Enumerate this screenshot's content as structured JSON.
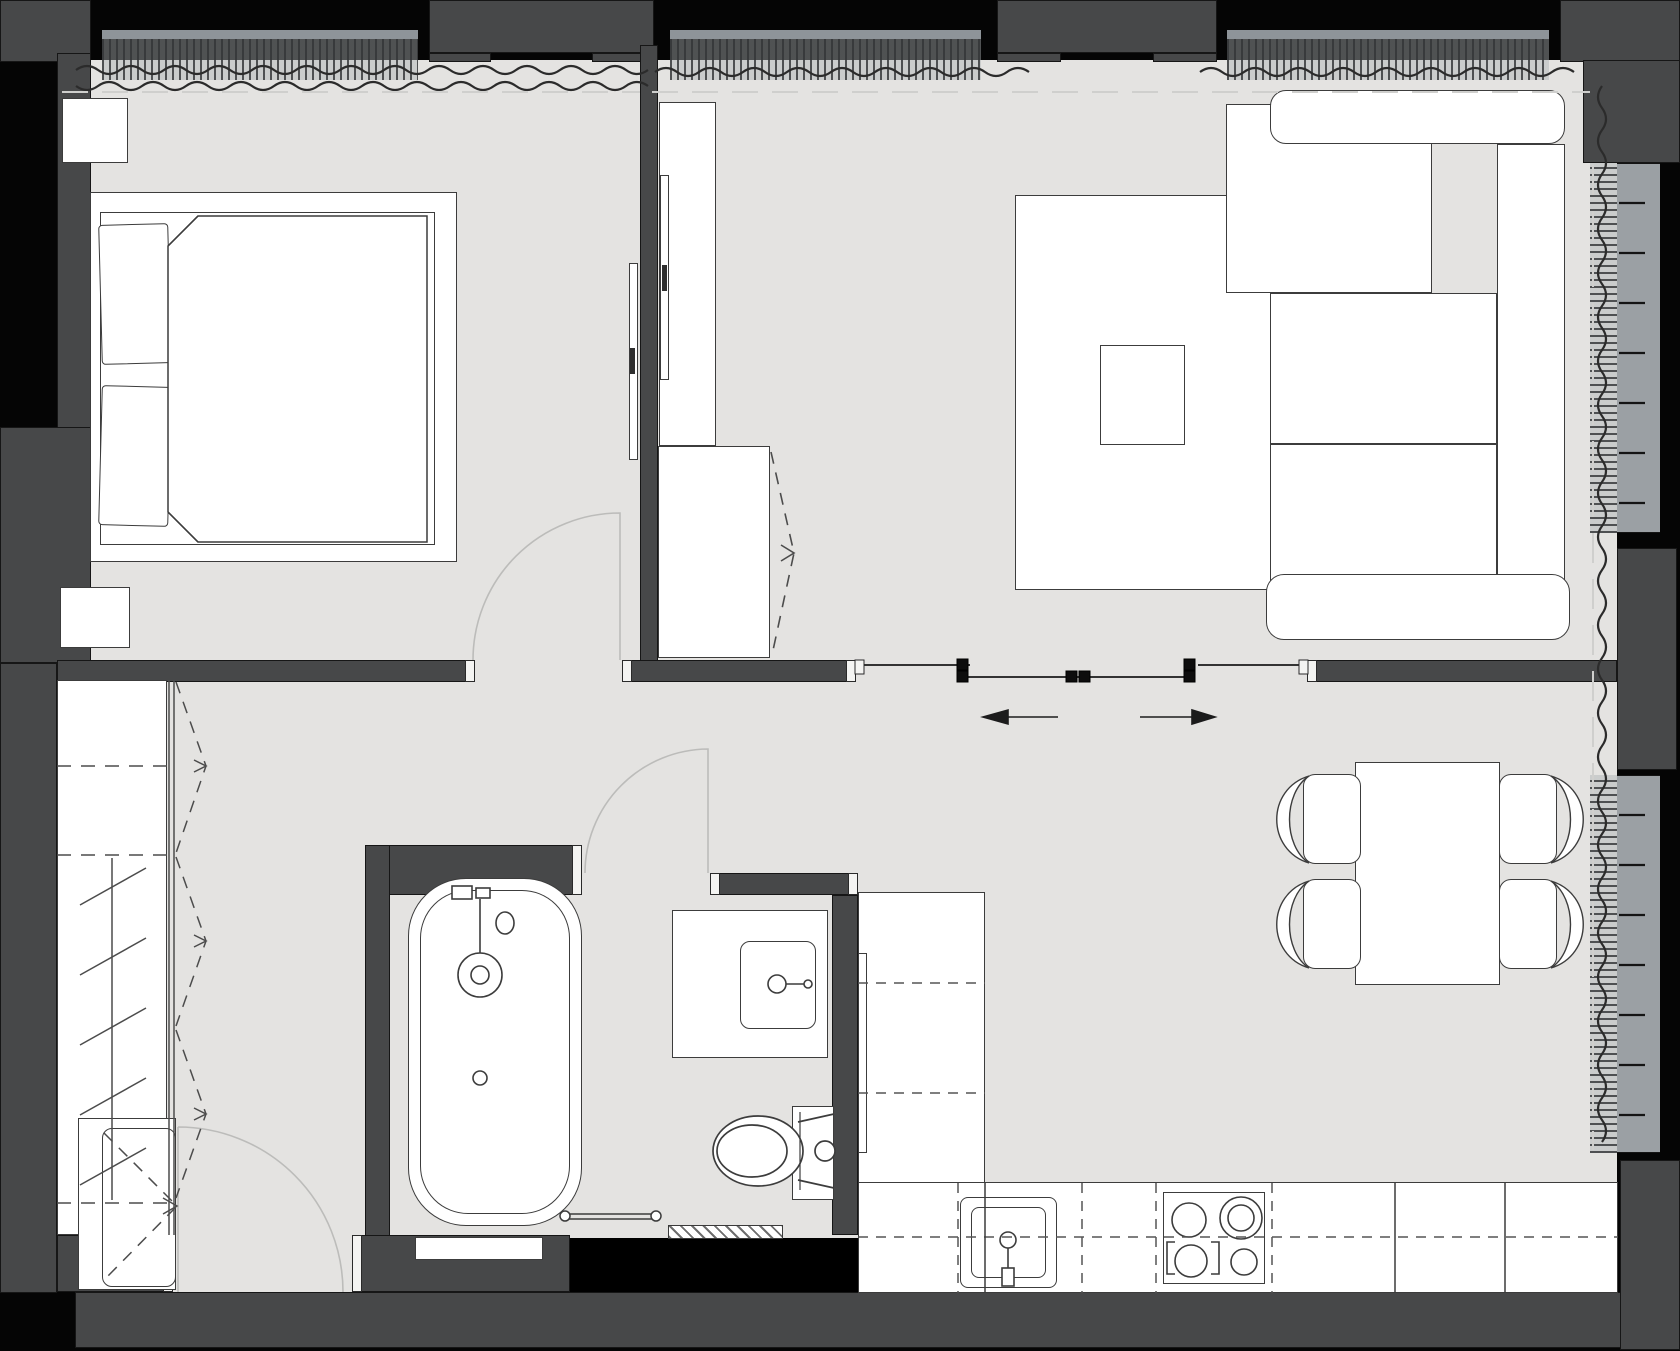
{
  "title": "Apartment floor plan — top view architectural drawing",
  "colors": {
    "outside": "#050505",
    "wall": "#474849",
    "floor": "#e4e3e1",
    "furn": "#ffffff",
    "line": "#3c3c3c",
    "comb": "#9aa0a3",
    "combbar": "#8e9499",
    "sill": "#9ba0a4",
    "dashlight": "#cfcfcd",
    "arc": "#bcbcba",
    "curtain": "#2b2b2b"
  },
  "rooms": [
    {
      "key": "bedroom",
      "label": "Bedroom",
      "furniture": [
        "double-bed",
        "two-pillows",
        "blanket",
        "nightstand-top",
        "nightstand-bottom",
        "wall-tv"
      ]
    },
    {
      "key": "living-room",
      "label": "Living room",
      "furniture": [
        "corner-sofa",
        "rug",
        "coffee-table",
        "tv-column",
        "tv-panel",
        "storage-cabinet"
      ]
    },
    {
      "key": "dining-area",
      "label": "Dining area",
      "furniture": [
        "dining-table",
        "chair-1",
        "chair-2",
        "chair-3",
        "chair-4"
      ]
    },
    {
      "key": "kitchen",
      "label": "Kitchen",
      "furniture": [
        "l-shaped-counter",
        "kitchen-sink",
        "cooktop-4-burners",
        "upper-cabinets-dashed"
      ]
    },
    {
      "key": "bathroom",
      "label": "Bathroom",
      "furniture": [
        "bathtub",
        "washbasin-counter",
        "toilet",
        "towel-rail"
      ]
    },
    {
      "key": "hallway",
      "label": "Hallway",
      "furniture": [
        "wardrobe-folding-doors",
        "hanging-rail",
        "entrance-cabinet"
      ]
    }
  ],
  "doors": {
    "entrance": "swing door, bottom-left, opens into hallway",
    "bedroom": "swing door in south wall, opens into bedroom",
    "bathroom": "swing door, opens out into hallway",
    "sliding": "double sliding partition between living room and dining/kitchen, arrows left and right"
  },
  "windows": {
    "top": [
      "bedroom window with radiator and curtain",
      "living room window left",
      "living room window right"
    ],
    "right": [
      "living room side window upper",
      "dining side window lower"
    ]
  },
  "symbols": {
    "wavy_line": "curtain",
    "comb_strip": "radiator / convector",
    "dashed_v": "folding door swing",
    "arrow": "sliding direction"
  }
}
